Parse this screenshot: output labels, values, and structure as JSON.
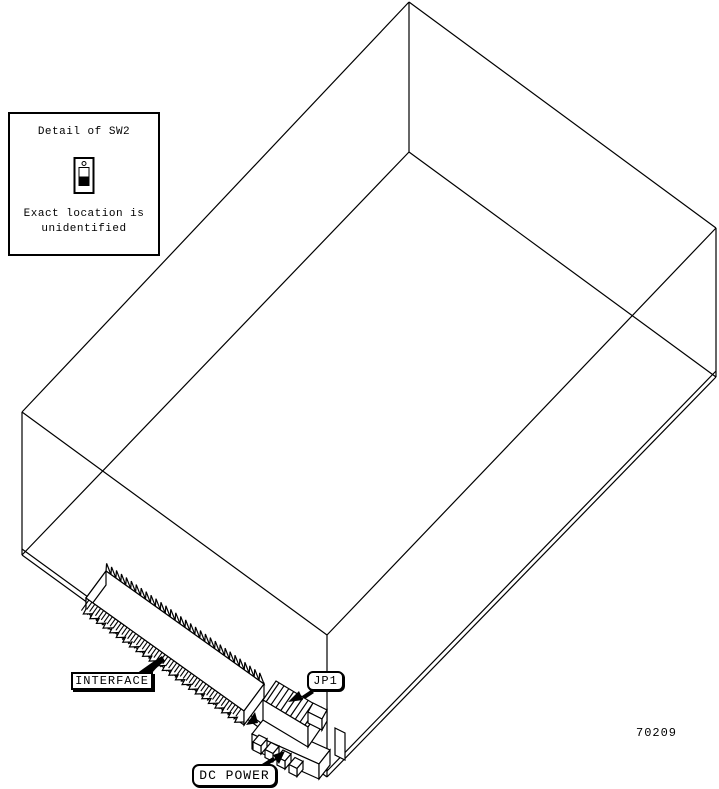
{
  "figure": {
    "part_number": "70209",
    "detail_box": {
      "title": "Detail of SW2",
      "note_line1": "Exact location is",
      "note_line2": "unidentified"
    },
    "callouts": {
      "interface_label": "INTERFACE",
      "jp1_label": "JP1",
      "dc_power_label": "DC POWER"
    },
    "icons": {
      "switch": "toggle-switch-icon"
    },
    "colors": {
      "line": "#000000",
      "background": "#ffffff"
    }
  }
}
